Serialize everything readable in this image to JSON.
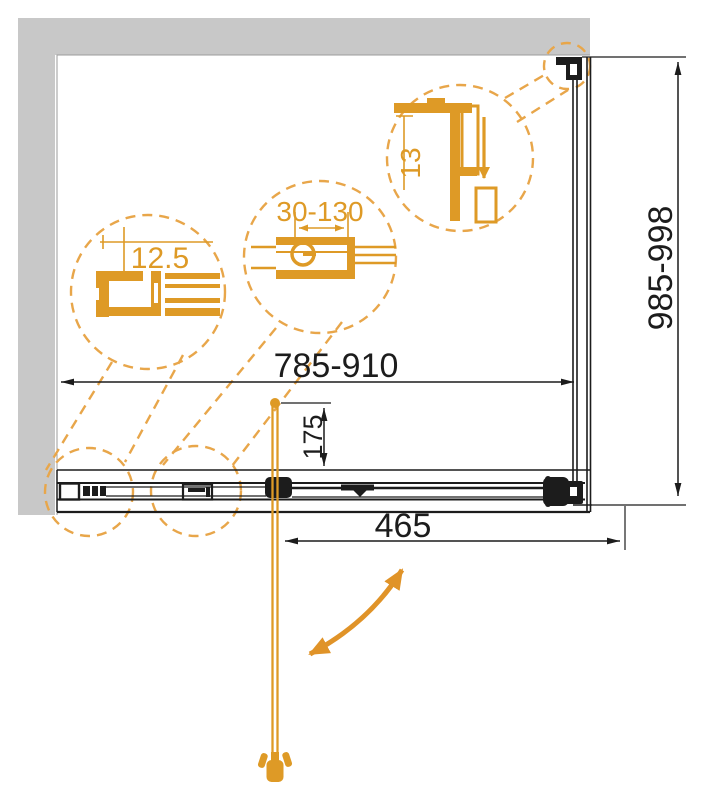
{
  "drawing": {
    "kind": "shower-enclosure-installation-diagram",
    "dimensions": {
      "width_label": "785-910",
      "height_label": "985-998",
      "door_width_label": "465",
      "handle_offset_label": "175"
    },
    "details": {
      "detail1_label": "12.5",
      "detail2_label": "30-130",
      "detail3_label": "13"
    },
    "colors": {
      "orange": "#DE9A26",
      "dashed_orange": "#E8A64A",
      "wall_gray": "#C8C8C8",
      "line": "#1C1C1C",
      "background": "#FFFFFF"
    }
  }
}
